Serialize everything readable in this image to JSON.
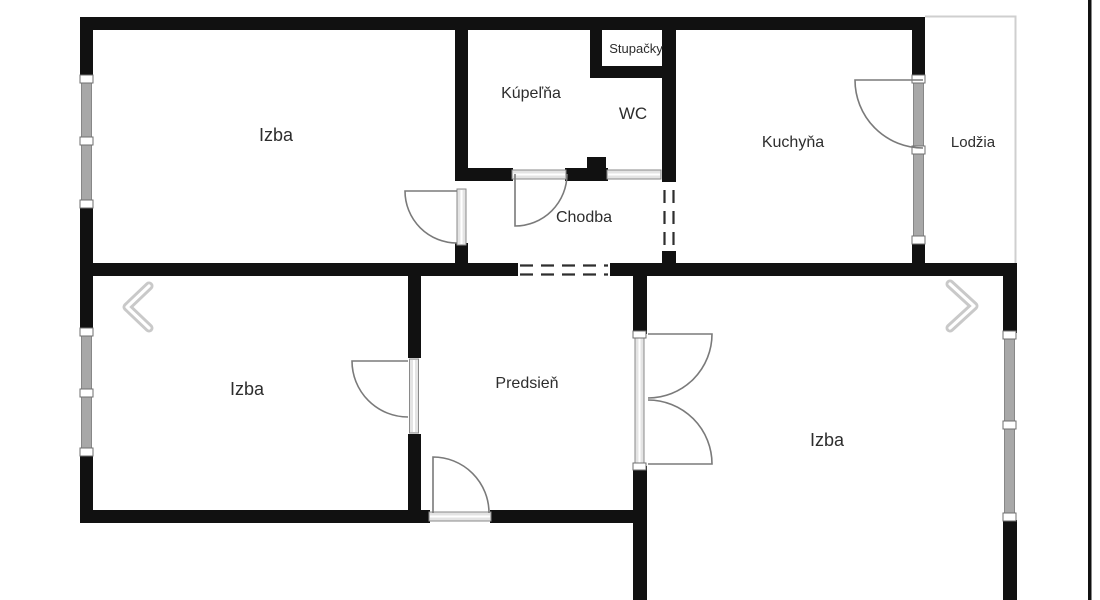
{
  "image_type": "floor-plan-photo",
  "gallery": {
    "prev_icon": "chevron-left",
    "next_icon": "chevron-right"
  },
  "floorplan": {
    "rooms": [
      {
        "id": "izba-top-left",
        "label": "Izba"
      },
      {
        "id": "kupelna",
        "label": "Kúpeľňa"
      },
      {
        "id": "stupacky",
        "label": "Stupačky"
      },
      {
        "id": "wc",
        "label": "WC"
      },
      {
        "id": "kuchyna",
        "label": "Kuchyňa"
      },
      {
        "id": "lodzia",
        "label": "Lodžia"
      },
      {
        "id": "chodba",
        "label": "Chodba"
      },
      {
        "id": "izba-bottom-left",
        "label": "Izba"
      },
      {
        "id": "predsien",
        "label": "Predsieň"
      },
      {
        "id": "izba-bottom-right",
        "label": "Izba"
      }
    ],
    "colors": {
      "background": "#ffffff",
      "wall": "#111111",
      "window": "#a8a8a8",
      "door_arc": "#7a7a7a",
      "label": "#2d2d2d",
      "dashed_opening": "#2e2e2e",
      "loggia_outline": "#cfcfcf",
      "chevron": "#c9c9c9",
      "photo_edge": "#111111"
    }
  }
}
